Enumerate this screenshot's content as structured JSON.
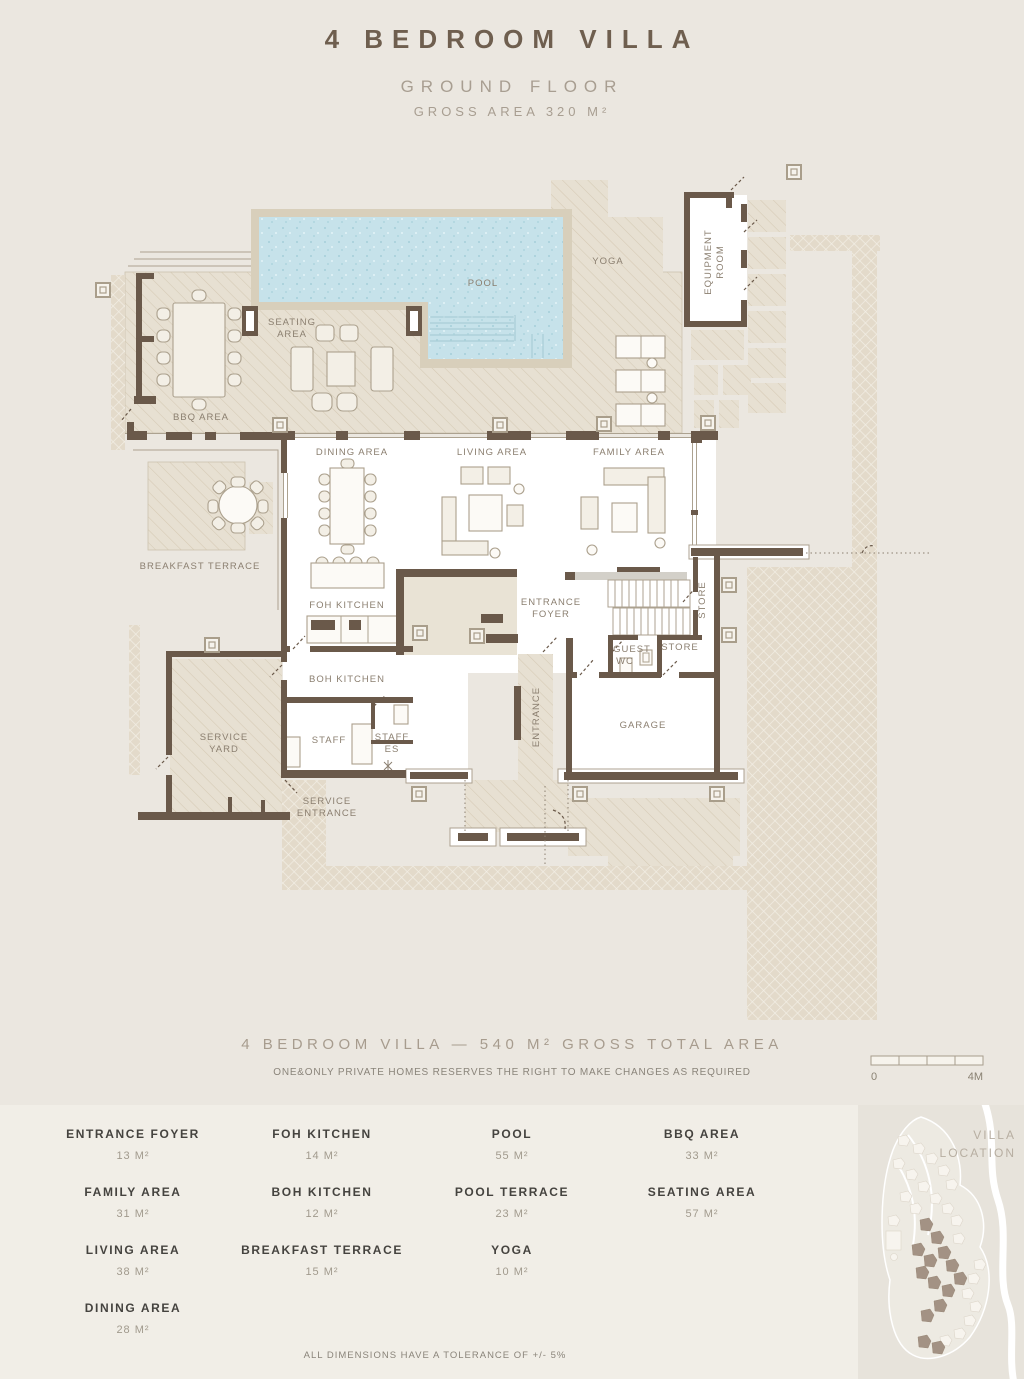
{
  "title": {
    "main": "4 BEDROOM VILLA",
    "floor": "GROUND FLOOR",
    "gross": "GROSS AREA 320 M²"
  },
  "plan": {
    "labels": {
      "pool": [
        "POOL"
      ],
      "yoga": [
        "YOGA"
      ],
      "equipment": [
        "EQUIPMENT",
        "ROOM"
      ],
      "seating": [
        "SEATING",
        "AREA"
      ],
      "bbq": [
        "BBQ AREA"
      ],
      "breakfast": [
        "BREAKFAST TERRACE"
      ],
      "dining": [
        "DINING AREA"
      ],
      "living": [
        "LIVING AREA"
      ],
      "family": [
        "FAMILY AREA"
      ],
      "foh": [
        "FOH KITCHEN"
      ],
      "boh": [
        "BOH KITCHEN"
      ],
      "entrance_foyer": [
        "ENTRANCE",
        "FOYER"
      ],
      "guest_wc": [
        "GUEST",
        "WC"
      ],
      "store_tall": [
        "STORE"
      ],
      "store_small": [
        "STORE"
      ],
      "staff": [
        "STAFF"
      ],
      "staff_es": [
        "STAFF",
        "ES"
      ],
      "service_yard": [
        "SERVICE",
        "YARD"
      ],
      "service_entrance": [
        "SERVICE",
        "ENTRANCE"
      ],
      "garage": [
        "GARAGE"
      ],
      "entrance_corridor": [
        "ENTRANCE"
      ]
    }
  },
  "footer": {
    "total": "4 BEDROOM VILLA — 540 M² GROSS TOTAL AREA",
    "disclaimer": "ONE&ONLY PRIVATE HOMES RESERVES THE RIGHT TO MAKE CHANGES AS REQUIRED",
    "scale": {
      "zero": "0",
      "max": "4M"
    }
  },
  "legend": {
    "columns": [
      {
        "items": [
          {
            "name": "ENTRANCE FOYER",
            "area": "13 M²"
          },
          {
            "name": "FAMILY AREA",
            "area": "31 M²"
          },
          {
            "name": "LIVING AREA",
            "area": "38 M²"
          },
          {
            "name": "DINING AREA",
            "area": "28 M²"
          }
        ]
      },
      {
        "items": [
          {
            "name": "FOH KITCHEN",
            "area": "14 M²"
          },
          {
            "name": "BOH KITCHEN",
            "area": "12 M²"
          },
          {
            "name": "BREAKFAST TERRACE",
            "area": "15 M²"
          }
        ]
      },
      {
        "items": [
          {
            "name": "POOL",
            "area": "55 M²"
          },
          {
            "name": "POOL TERRACE",
            "area": "23 M²"
          },
          {
            "name": "YOGA",
            "area": "10 M²"
          }
        ]
      },
      {
        "items": [
          {
            "name": "BBQ AREA",
            "area": "33 M²"
          },
          {
            "name": "SEATING AREA",
            "area": "57 M²"
          }
        ]
      }
    ]
  },
  "map": {
    "lines": [
      "VILLA",
      "LOCATION"
    ]
  },
  "tolerance": "ALL DIMENSIONS HAVE A TOLERANCE OF +/- 5%",
  "colors": {
    "wall": "#6A594A",
    "pool": "#C6E2EA",
    "logo": "#B96F52",
    "hatch": "#E7E0D2",
    "background": "#EBE7E0"
  }
}
